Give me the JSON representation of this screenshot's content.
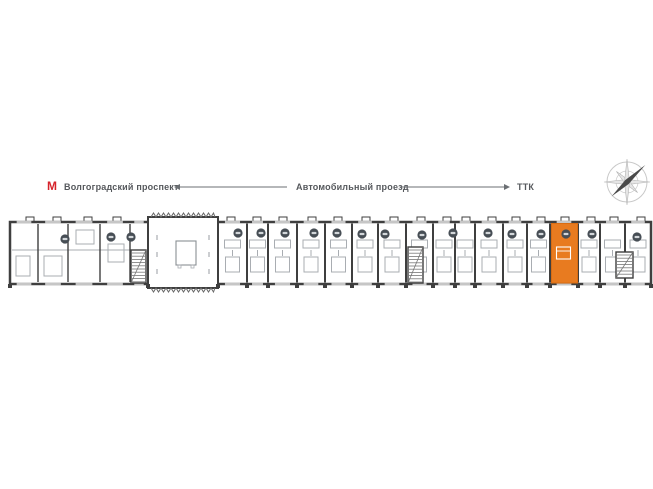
{
  "header": {
    "metro_icon": "М",
    "metro_station": "Волгоградский проспект",
    "road": "Автомобильный проезд",
    "highway": "ТТК"
  },
  "colors": {
    "wall": "#3f3f3f",
    "detail": "#a9adb2",
    "badge": "#474e55",
    "badge_dash": "#d3d7da",
    "highlight": "#e87b20",
    "highlight_edge": "#d96c12",
    "metro_red": "#d6232b",
    "label_text": "#55585c",
    "arrow": "#6b6f73",
    "compass_light": "#c9c9c9",
    "compass_dark": "#4a4a4a"
  },
  "plan": {
    "outline": {
      "x": 10,
      "y": 222,
      "w": 641,
      "h": 62
    },
    "lobby": {
      "x": 148,
      "y": 217,
      "w": 70,
      "h": 71
    },
    "lobby_desk": {
      "x": 176,
      "y": 241,
      "w": 20,
      "h": 24
    },
    "dividers": [
      247,
      268,
      297,
      325,
      352,
      378,
      406,
      433,
      455,
      475,
      503,
      527,
      550,
      578,
      600,
      625
    ],
    "left_walls": [
      38,
      68,
      100,
      130
    ],
    "left_corridor_y": 250,
    "left_details": [
      [
        16,
        256,
        14,
        20
      ],
      [
        44,
        256,
        18,
        20
      ],
      [
        76,
        230,
        18,
        14
      ],
      [
        108,
        244,
        16,
        18
      ]
    ],
    "window_bounds": [
      10,
      38,
      68,
      100,
      130,
      148,
      218,
      247,
      268,
      297,
      325,
      352,
      378,
      406,
      433,
      455,
      475,
      503,
      527,
      550,
      578,
      600,
      625,
      651
    ],
    "top_bumps": [
      30,
      57,
      88,
      117,
      231,
      257,
      283,
      312,
      338,
      366,
      394,
      421,
      447,
      466,
      492,
      516,
      541,
      565,
      591,
      614,
      641
    ],
    "badges": [
      [
        65,
        239
      ],
      [
        111,
        237
      ],
      [
        131,
        237
      ],
      [
        238,
        233
      ],
      [
        261,
        233
      ],
      [
        285,
        233
      ],
      [
        314,
        233
      ],
      [
        337,
        233
      ],
      [
        362,
        234
      ],
      [
        385,
        234
      ],
      [
        422,
        235
      ],
      [
        453,
        233
      ],
      [
        488,
        233
      ],
      [
        512,
        234
      ],
      [
        541,
        234
      ],
      [
        566,
        234
      ],
      [
        592,
        234
      ],
      [
        637,
        237
      ]
    ],
    "cores": [
      [
        131,
        250,
        15,
        33
      ],
      [
        408,
        247,
        15,
        36
      ],
      [
        616,
        252,
        17,
        26
      ]
    ],
    "highlight_unit": {
      "x": 551.5,
      "y": 223.5,
      "w": 26,
      "h": 59.5
    },
    "orange_span": [
      550,
      578
    ]
  },
  "arrows": {
    "left": {
      "x1": 287,
      "x2": 180,
      "y": 187
    },
    "right": {
      "x1": 400,
      "x2": 504,
      "y": 187
    }
  },
  "compass": {
    "cx": 627,
    "cy": 182,
    "r": 20
  }
}
